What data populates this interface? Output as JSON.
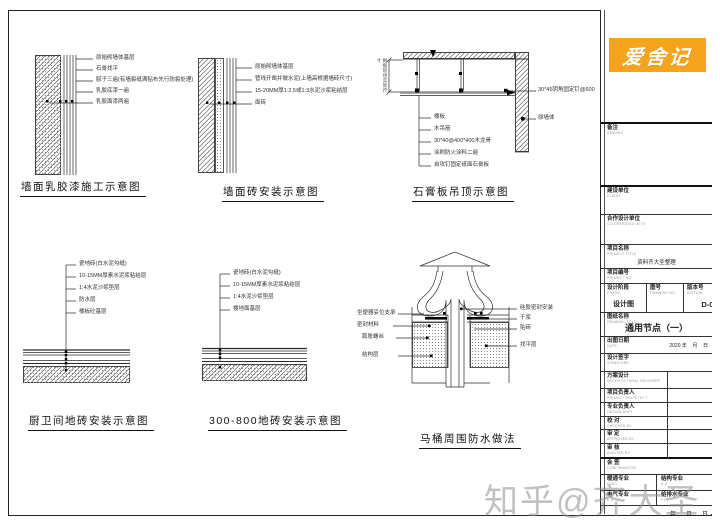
{
  "brand": {
    "logo_text": "爱舍记",
    "logo_bg": "#F5A41D"
  },
  "watermark": {
    "text": "知乎@齐大圣",
    "color": "#8f8f8f"
  },
  "diagrams": {
    "d1": {
      "title": "墙面乳胶漆施工示意图",
      "labels": [
        "原始砌墙体基层",
        "石膏找平",
        "腻子三遍(有墙裂缝满贴布先行防裂处理)",
        "乳胶底漆一遍",
        "乳胶面漆两遍"
      ]
    },
    "d2": {
      "title": "墙面砖安装示意图",
      "labels": [
        "原始砌墙体基层",
        "管线开凿并做水泥(上墙高根据墙砖尺寸)",
        "15-20MM厚1:2.5或1:3水泥沙浆粘结层",
        "面砖"
      ]
    },
    "d3": {
      "title": "石膏板吊顶示意图",
      "labels": [
        "楼板",
        "木吊筋",
        "30*40@400*400木龙骨",
        "涂刷防火涂料二遍",
        "自攻钉固定纸面石膏板"
      ],
      "right_labels": [
        "30*45阴角固定钉@600",
        "原墙体"
      ],
      "dim_label": "根据现场实际尺寸"
    },
    "d4": {
      "title": "厨卫间地砖安装示意图",
      "labels": [
        "瓷地砖(白水泥勾缝)",
        "10-15MM厚素水泥浆粘结层",
        "1:4水泥沙浆垫层",
        "防水层",
        "楼板砼基层"
      ]
    },
    "d5": {
      "title": "300-800地砖安装示意图",
      "labels": [
        "瓷地砖(白水泥勾缝)",
        "10-15MM厚素水泥浆粘结层",
        "1:4水泥沙浆垫层",
        "楼地面基层"
      ]
    },
    "d6": {
      "title": "马桶周围防水做法",
      "left_labels": [
        "坐便器妥位支承",
        "密封材料",
        "膨胀螺丝",
        "结构层"
      ],
      "right_labels": [
        "硅胶密封安装",
        "干浆",
        "贴砖",
        "找平层"
      ]
    }
  },
  "titleblock": {
    "remark": {
      "cn": "备注",
      "en": "REMARK"
    },
    "client": {
      "cn": "建设单位",
      "en": "CLIENT"
    },
    "coop": {
      "cn": "合作设计单位",
      "en": "CO-OPERATED WITH"
    },
    "project": {
      "cn": "项目名称",
      "en": "PROJECT TITLE",
      "value": "资料齐大圣整理"
    },
    "project_no": {
      "cn": "项目编号",
      "en": "PROJECT NO"
    },
    "phase": {
      "cn": "设计阶段",
      "en": "PHASE",
      "value": "设计图"
    },
    "drawing_no": {
      "cn": "图号",
      "en": "DRAWING NO",
      "value": "D-01"
    },
    "edition": {
      "cn": "版本号",
      "en": "EDITION",
      "value": "01"
    },
    "drawing_title": {
      "cn": "图纸名称",
      "en": "DRAWING TITLE",
      "value": "通用节点（一）"
    },
    "date": {
      "cn": "出图日期",
      "en": "DATE",
      "value": "2020 年    月    日"
    },
    "signature": {
      "cn": "设计签字",
      "en": "SIGNATURE"
    },
    "scheme": {
      "cn": "方案设计",
      "en": "ARCHITECTURAL DESIGNER"
    },
    "pm": {
      "cn": "项目负责人",
      "en": "PROJECT ARCHITECT"
    },
    "lead": {
      "cn": "专业负责人",
      "en": "DESIGN DEPT"
    },
    "proof": {
      "cn": "校 对",
      "en": "CHECKED BY"
    },
    "approve": {
      "cn": "审 定",
      "en": "APPROVED BY"
    },
    "audit": {
      "cn": "审 核",
      "en": "AUDITED BY"
    },
    "countersign": {
      "cn": "会 签",
      "en": "CONFIRMATION"
    },
    "spec_hvac": {
      "cn": "暖通专业",
      "en": "HVAC"
    },
    "spec_struct": {
      "cn": "结构专业",
      "en": "S.E."
    },
    "spec_elec": {
      "cn": "电气专业",
      "en": "E.E."
    },
    "spec_plumb": {
      "cn": "给排水专业",
      "en": "P.E."
    },
    "sign_date": {
      "cn": "会签日期",
      "en": "DATE",
      "value": "年      月      日"
    }
  }
}
